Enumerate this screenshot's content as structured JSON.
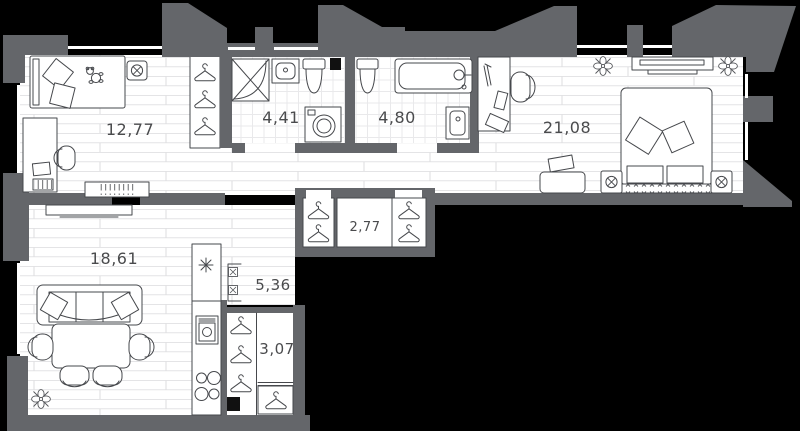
{
  "plan": {
    "type": "apartment-floor-plan",
    "rooms": [
      {
        "id": "child-bedroom",
        "area": "12,77"
      },
      {
        "id": "shower-bathroom",
        "area": "4,41"
      },
      {
        "id": "bathroom",
        "area": "4,80"
      },
      {
        "id": "master-bedroom",
        "area": "21,08"
      },
      {
        "id": "hall-closet",
        "area": "2,77"
      },
      {
        "id": "living-room",
        "area": "18,61"
      },
      {
        "id": "kitchen",
        "area": "5,36"
      },
      {
        "id": "entry-hall",
        "area": "3,07"
      }
    ],
    "colors": {
      "background": "#000000",
      "wall": "#64666a",
      "floor": "#ffffff",
      "floor_line": "#e4e4e6",
      "furniture_line": "#46484c",
      "label": "#4a4b4d"
    }
  }
}
